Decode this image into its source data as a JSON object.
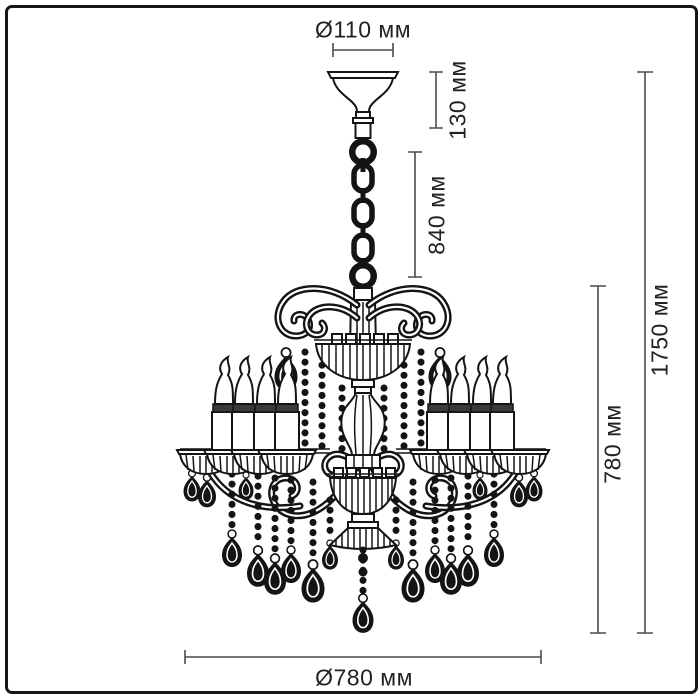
{
  "diagram": {
    "type": "product-dimension-drawing",
    "subject": "chandelier"
  },
  "dimensions": {
    "canopy_diameter": "Ø110 мм",
    "canopy_height": "130 мм",
    "suspension_height": "840 мм",
    "body_height": "780 мм",
    "total_height": "1750 мм",
    "body_diameter": "Ø780 мм"
  },
  "style": {
    "background": "#ffffff",
    "border_color": "#161616",
    "drawing_color": "#141414",
    "dimension_line_color": "#4c4c4c",
    "text_color": "#222222"
  }
}
